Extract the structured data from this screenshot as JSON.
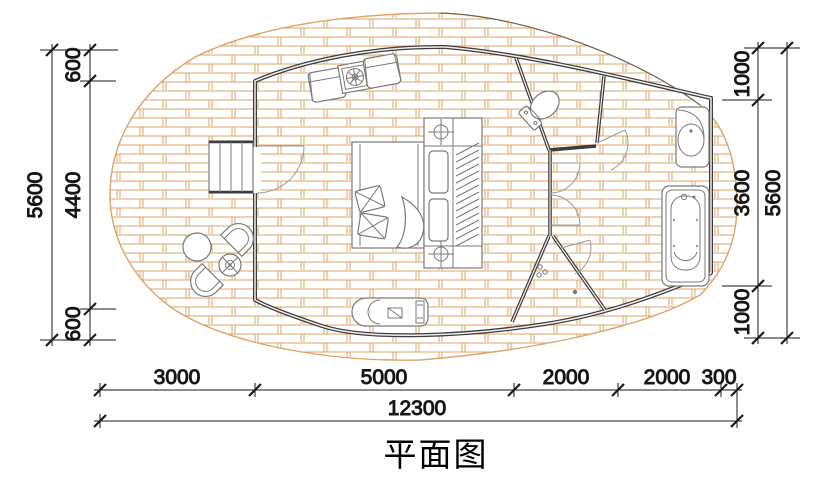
{
  "title": "平面图",
  "dims": {
    "left_segments": [
      "600",
      "4400",
      "600"
    ],
    "left_total": "5600",
    "right_segments": [
      "1000",
      "3600",
      "1000"
    ],
    "right_total": "5600",
    "bottom_segments": [
      "3000",
      "5000",
      "2000",
      "2000",
      "300"
    ],
    "bottom_total": "12300"
  },
  "colors": {
    "deck_brick": "#dda468",
    "wall": "#3c3c3c",
    "furniture_line": "#7a7a7a",
    "dimension_line": "#1a1a1a",
    "background": "#ffffff"
  },
  "furniture": {
    "deck": "brick-paved terrace",
    "entry": [
      "entry-stairs",
      "entry-door"
    ],
    "bedroom": [
      "armchair",
      "side-table",
      "armchair",
      "double-bed",
      "pillows",
      "bedside-lamps",
      "wardrobe",
      "tv-console"
    ],
    "outdoor": [
      "lounge-chair",
      "round-table",
      "parasol-table",
      "lounge-chair"
    ],
    "bathroom": [
      "toilet",
      "corridor-doors",
      "shower-area",
      "washbasin",
      "bathtub"
    ]
  }
}
